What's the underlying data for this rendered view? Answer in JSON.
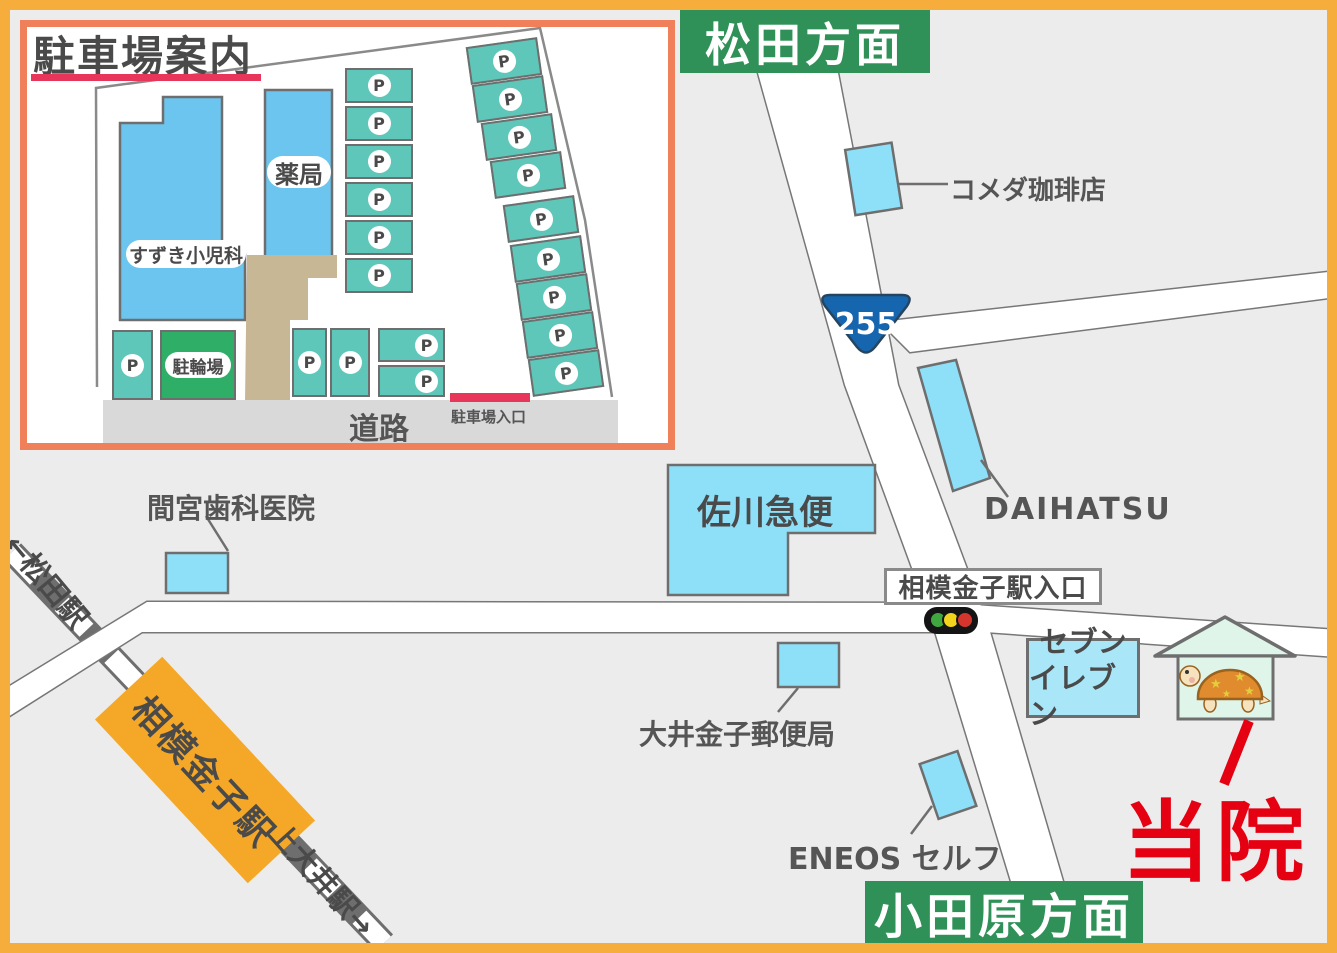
{
  "inset": {
    "title": "駐車場案内",
    "pediatrics_label": "すずき小児科",
    "pharmacy_label": "薬局",
    "bicycle_parking_label": "駐輪場",
    "parking_label": "P",
    "road_label": "道路",
    "entrance_label": "駐車場入口"
  },
  "signs": {
    "north": "松田方面",
    "south": "小田原方面"
  },
  "route_badge": "255",
  "landmarks": {
    "komeda": "コメダ珈琲店",
    "daihatsu": "DAIHATSU",
    "sagawa": "佐川急便",
    "mamiya": "間宮歯科医院",
    "intersection": "相模金子駅入口",
    "seven_line1": "セブン",
    "seven_line2": "イレブン",
    "post_office": "大井金子郵便局",
    "eneos": "ENEOS セルフ",
    "clinic_here": "当院"
  },
  "railway": {
    "matsuda_arrow": "←松田駅",
    "station": "相模金子駅",
    "kamioi_arrow": "上大井駅→"
  },
  "colors": {
    "frame_orange": "#F6AD3B",
    "map_bg": "#ECECEC",
    "inset_border": "#F0805A",
    "building_blue_inset": "#6CC5EE",
    "building_blue": "#8EE0F9",
    "parking_teal": "#5FC7BA",
    "bicycle_green": "#2FAE68",
    "walkway_tan": "#C8B794",
    "road_gray": "#D9D9D9",
    "accent_red": "#E8365A",
    "sign_green": "#2F9157",
    "station_orange": "#F5A827",
    "route_blue": "#1565AF",
    "clinic_red": "#E50012"
  }
}
